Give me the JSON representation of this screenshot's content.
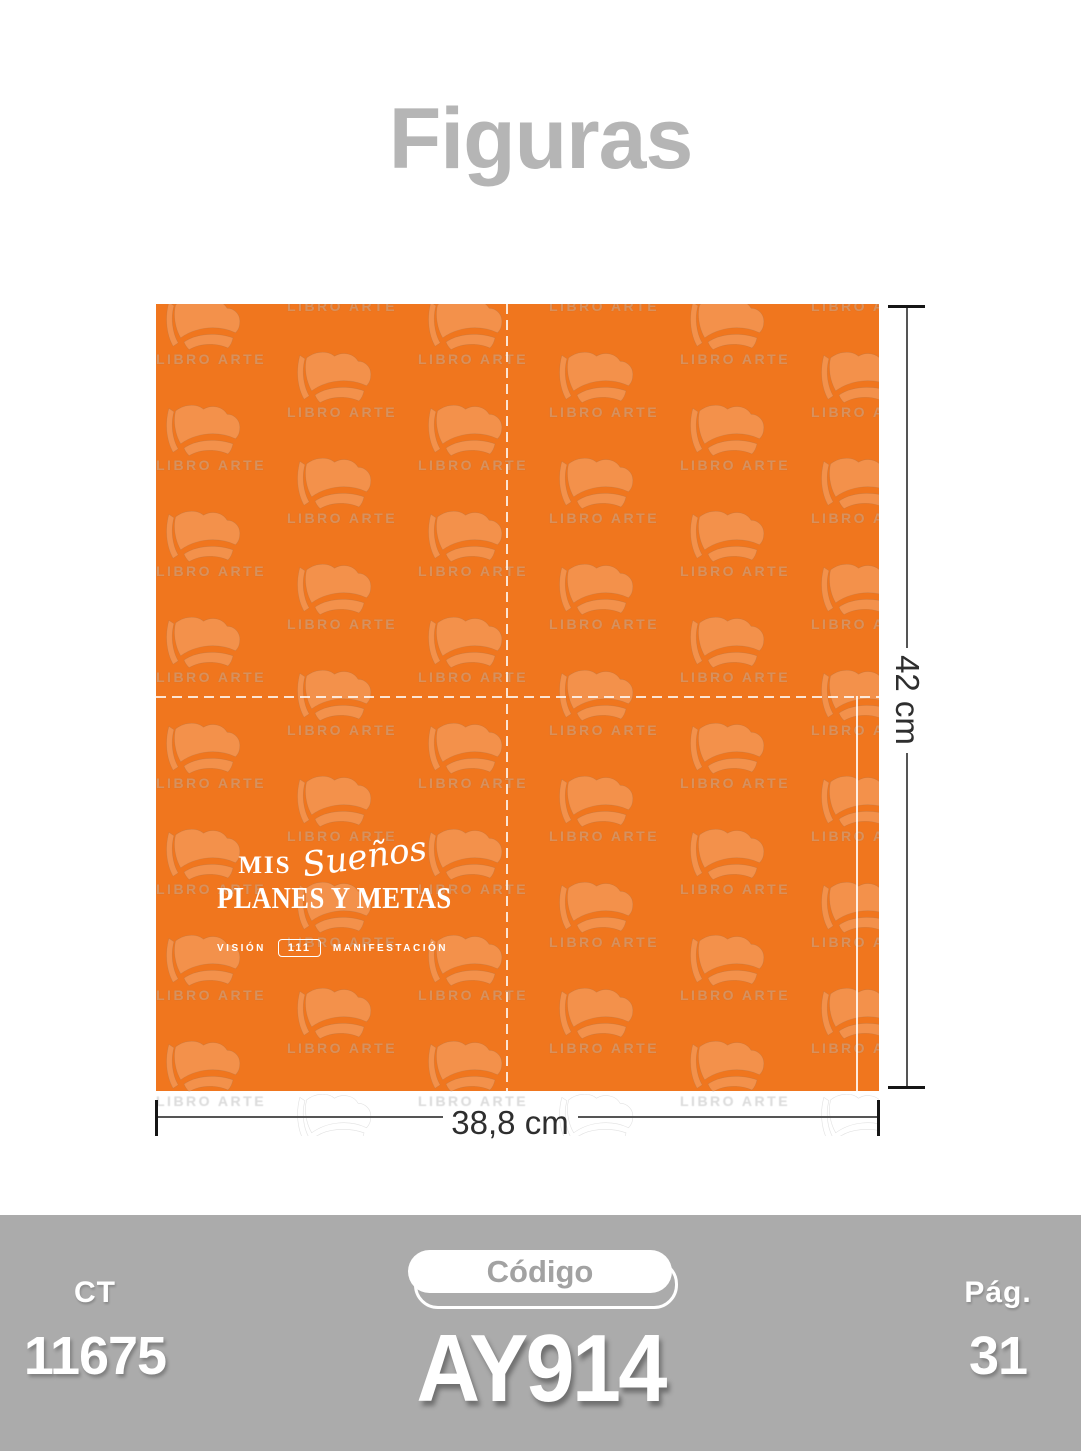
{
  "page": {
    "title": "Figuras"
  },
  "product": {
    "watermark_text": "LIBRO ARTE",
    "colors": {
      "panel_orange": "#F0761E",
      "footer_gray": "#ABABAB",
      "title_gray": "#B5B5B5"
    },
    "cover": {
      "line1_prefix": "MIS",
      "line1_script": "Sueños",
      "line2": "PLANES Y METAS",
      "sub_left": "VISIÓN",
      "sub_center": "111",
      "sub_right": "MANIFESTACIÓN"
    }
  },
  "dimensions": {
    "height_label": "42 cm",
    "width_label": "38,8 cm"
  },
  "footer": {
    "ct_label": "CT",
    "ct_value": "11675",
    "code_label": "Código",
    "code_value": "AY914",
    "page_label": "Pág.",
    "page_value": "31"
  }
}
